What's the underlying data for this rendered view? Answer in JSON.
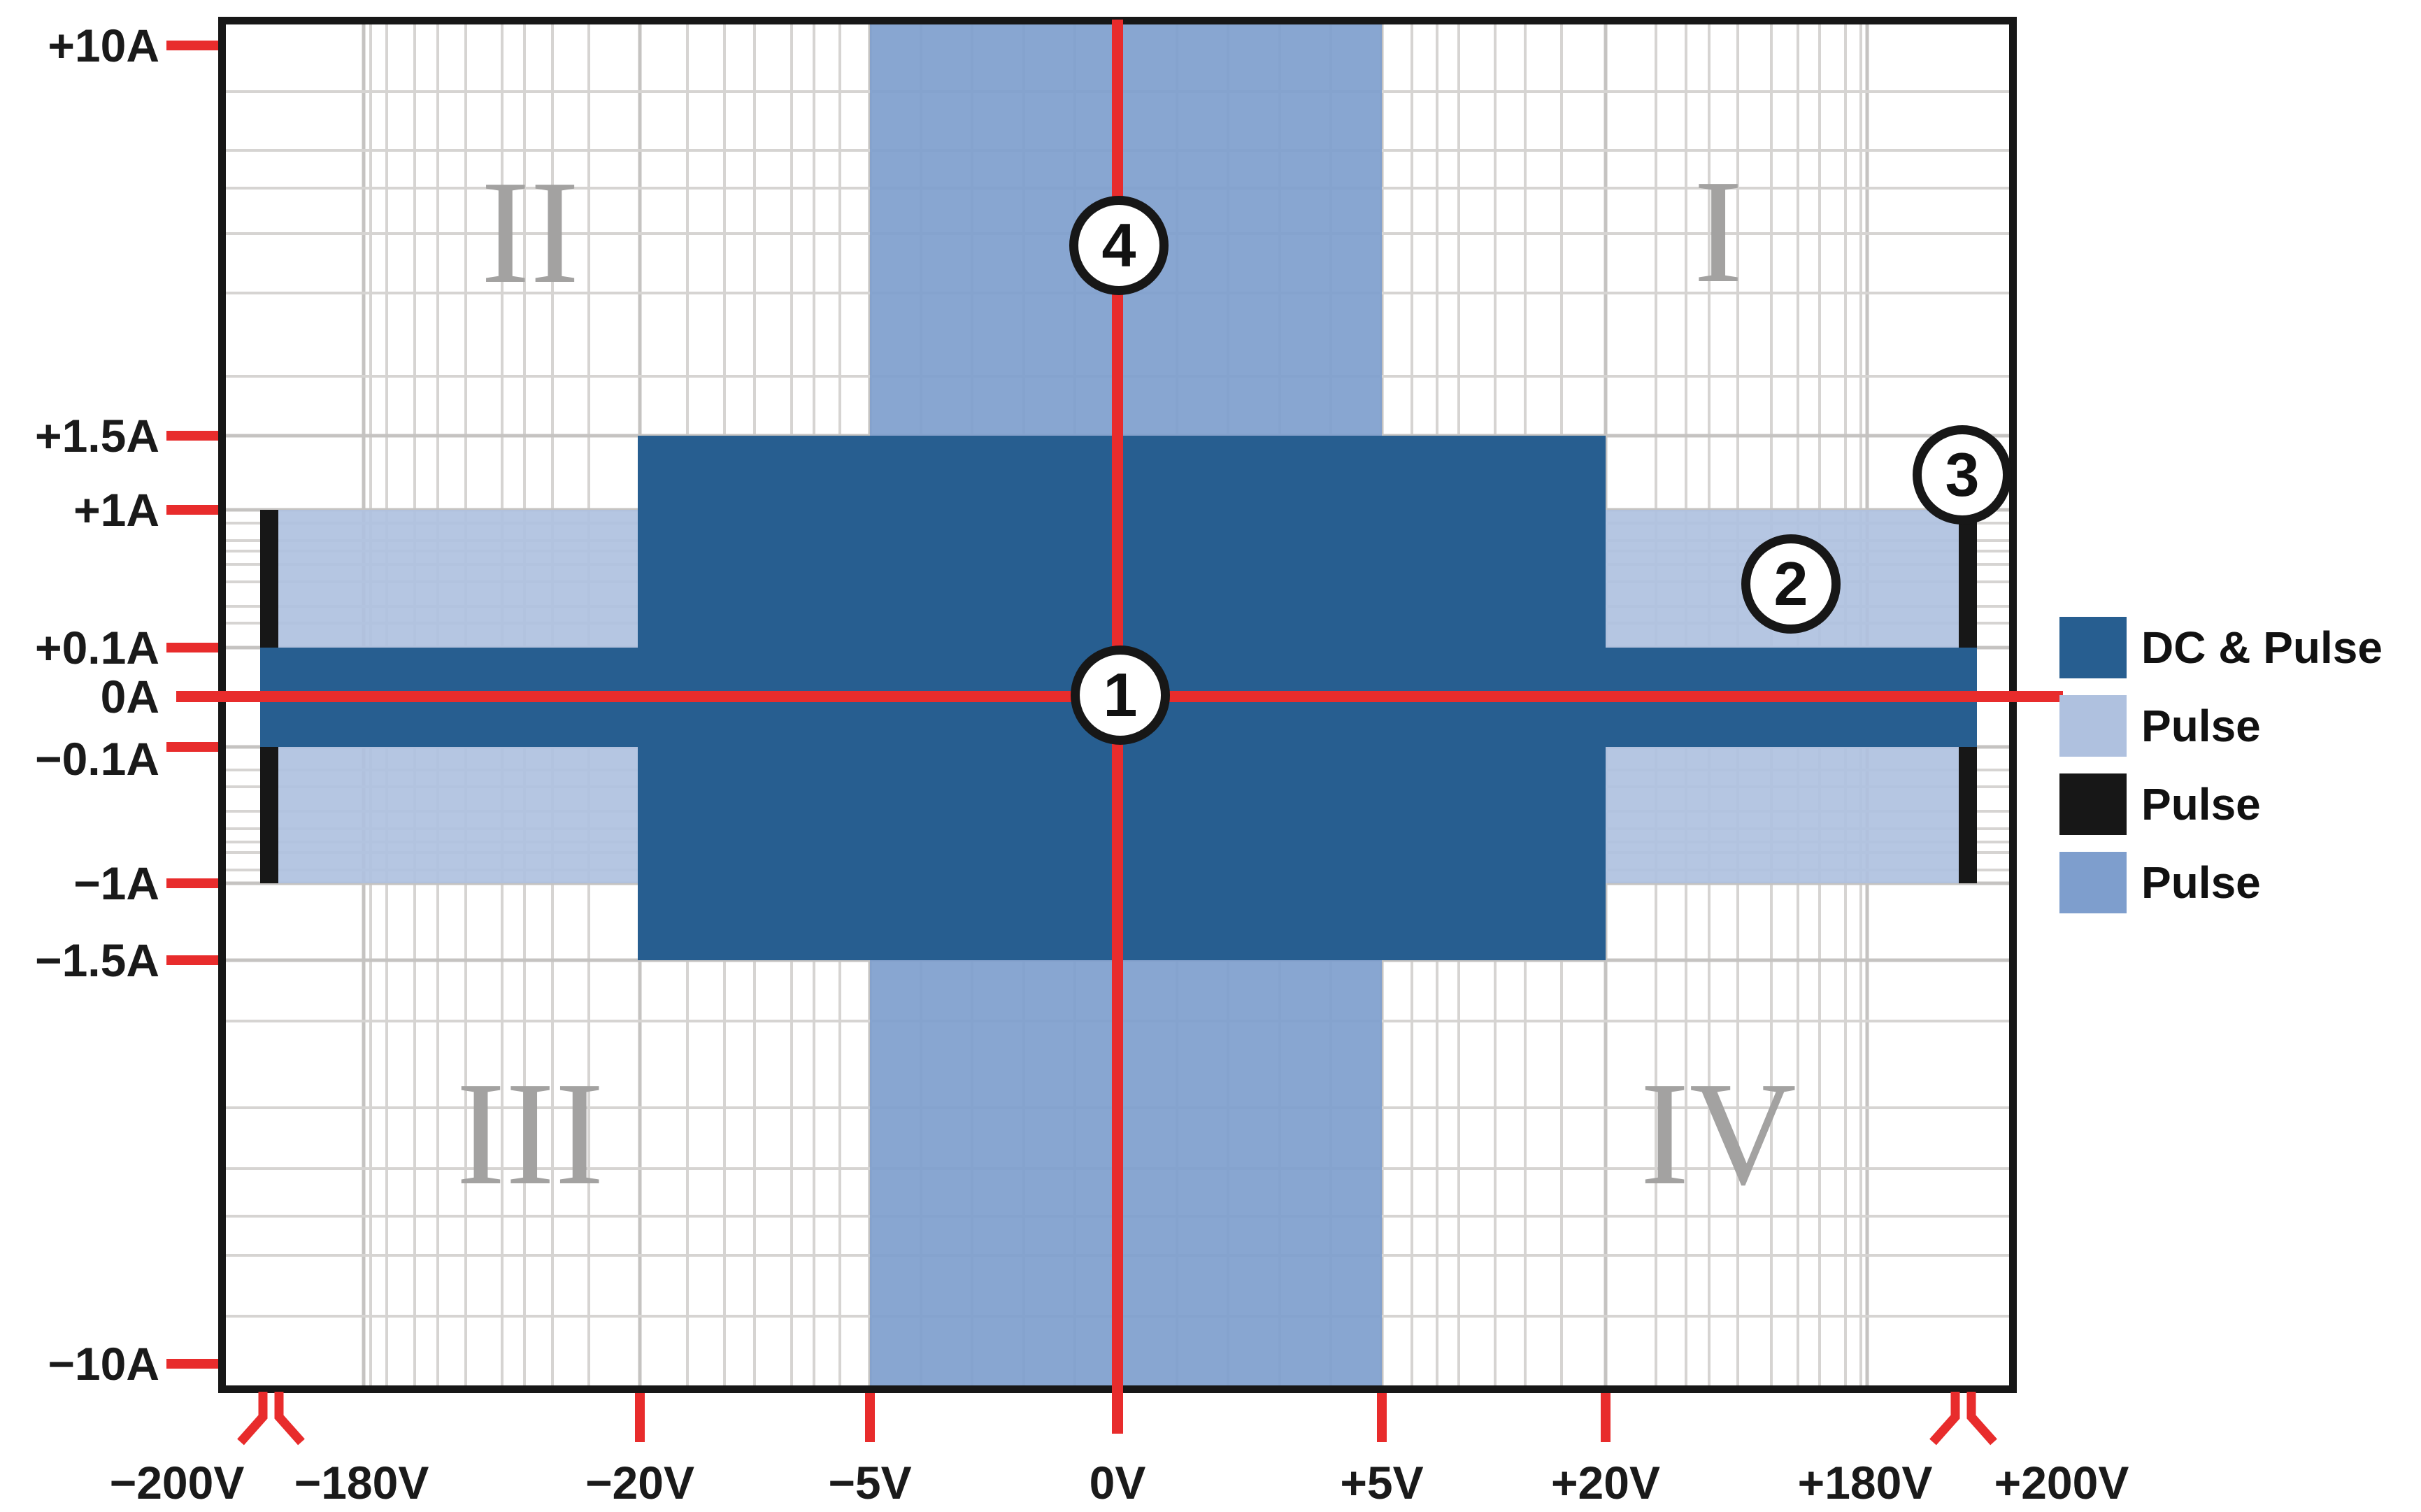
{
  "chart_data": {
    "type": "area",
    "title": "",
    "subtitle": "",
    "description": "Operating-area (voltage vs. current) envelope chart with four quadrants, broken voltage axis, colored DC/pulse capability regions and numbered callout markers",
    "x_axis": {
      "label": "Voltage",
      "tick_labels": [
        "−200V",
        "−180V",
        "−20V",
        "−5V",
        "0V",
        "+5V",
        "+20V",
        "+180V",
        "+200V"
      ],
      "axis_breaks": [
        "between −200V and −180V",
        "between +180V and +200V"
      ],
      "scale": "symmetric log-style with axis breaks near ±200V"
    },
    "y_axis": {
      "label": "Current",
      "tick_labels": [
        "+10A",
        "+1.5A",
        "+1A",
        "+0.1A",
        "0A",
        "−0.1A",
        "−1A",
        "−1.5A",
        "−10A"
      ],
      "scale": "symmetric log-style"
    },
    "grid": "on (log-style gray grid)",
    "legend_position": "right, outside plot",
    "quadrant_labels": [
      "I",
      "II",
      "III",
      "IV"
    ],
    "regions": [
      {
        "legend": "DC & Pulse",
        "color": "#275E90",
        "parts": [
          {
            "v_range": [
              -20,
              20
            ],
            "i_range": [
              -1.5,
              1.5
            ]
          },
          {
            "v_range": [
              -200,
              200
            ],
            "i_range": [
              -0.1,
              0.1
            ],
            "note": "thin band reaching the axis breaks near ±200V"
          }
        ]
      },
      {
        "legend": "Pulse",
        "color": "#AFC1DF",
        "parts": [
          {
            "v_range": [
              -200,
              200
            ],
            "i_range": [
              -1,
              1
            ],
            "note": "band between the two axis breaks"
          }
        ]
      },
      {
        "legend": "Pulse",
        "color": "#171717",
        "parts": [
          {
            "v_range": "±200V (vertical bars at the axis breaks)",
            "i_range": [
              -1,
              1
            ]
          }
        ]
      },
      {
        "legend": "Pulse",
        "color": "#7E9ECD",
        "parts": [
          {
            "v_range": [
              -5,
              5
            ],
            "i_range": [
              -10,
              10
            ]
          }
        ]
      }
    ],
    "markers": [
      {
        "label": "1",
        "at": "origin (0V, 0A), on red crosshair"
      },
      {
        "label": "2",
        "at": "quadrant I, inside light-blue pulse band (~+100V, ~+0.3A)"
      },
      {
        "label": "3",
        "at": "right axis break / black pulse bar, just above +1A"
      },
      {
        "label": "4",
        "at": "on 0V red line inside medium-blue pulse band (~+4A)"
      }
    ]
  },
  "axes": {
    "y": {
      "labels": [
        "+10A",
        "+1.5A",
        "+1A",
        "+0.1A",
        "0A",
        "−0.1A",
        "−1A",
        "−1.5A",
        "−10A"
      ]
    },
    "x": {
      "labels": [
        "−200V",
        "−180V",
        "−20V",
        "−5V",
        "0V",
        "+5V",
        "+20V",
        "+180V",
        "+200V"
      ]
    }
  },
  "legend": {
    "items": [
      {
        "label": "DC & Pulse",
        "color": "#275E90",
        "swatch": "dark-blue-square"
      },
      {
        "label": "Pulse",
        "color": "#AFC1DF",
        "swatch": "light-blue-square"
      },
      {
        "label": "Pulse",
        "color": "#171717",
        "swatch": "black-square"
      },
      {
        "label": "Pulse",
        "color": "#7E9ECD",
        "swatch": "medium-blue-square"
      }
    ]
  },
  "quadrants": [
    {
      "label": "II"
    },
    {
      "label": "I"
    },
    {
      "label": "III"
    },
    {
      "label": "IV"
    }
  ],
  "markers": [
    {
      "label": "1"
    },
    {
      "label": "2"
    },
    {
      "label": "3"
    },
    {
      "label": "4"
    }
  ],
  "colors": {
    "dc_pulse_dark_blue": "#275E90",
    "pulse_light_blue": "#AFC1DF",
    "pulse_black": "#171717",
    "pulse_medium_blue": "#7E9ECD",
    "crosshair_red": "#E82C2C",
    "grid_minor": "#D6D4D2",
    "grid_major": "#C5C3C1",
    "quadrant_numeral_gray": "#A3A2A1",
    "frame_black": "#171717"
  }
}
